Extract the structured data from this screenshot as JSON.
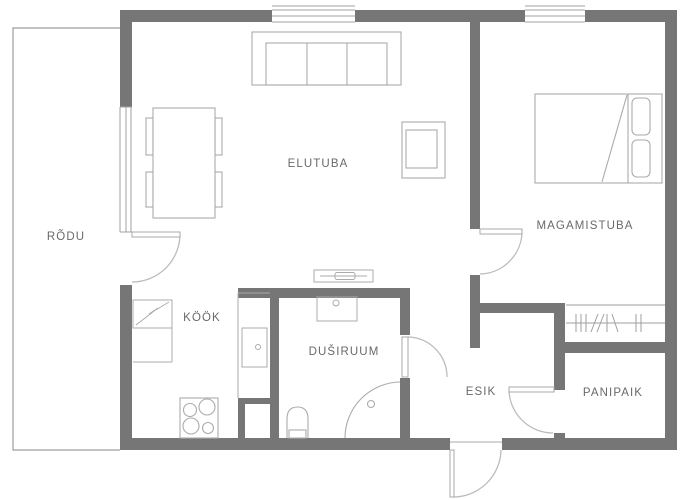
{
  "title": "Apartment floor plan",
  "rooms": [
    {
      "id": "rodu",
      "label": "RÕDU"
    },
    {
      "id": "elutuba",
      "label": "ELUTUBA"
    },
    {
      "id": "magamistuba",
      "label": "MAGAMISTUBA"
    },
    {
      "id": "kook",
      "label": "KÖÖK"
    },
    {
      "id": "dusiruum",
      "label": "DUŠIRUUM"
    },
    {
      "id": "esik",
      "label": "ESIK"
    },
    {
      "id": "panipaik",
      "label": "PANIPAIK"
    }
  ],
  "fixtures": [
    "sofa",
    "dining-table",
    "dining-chairs",
    "armchair",
    "radiator",
    "double-bed",
    "pillows",
    "clothes-rail",
    "electric-boiler",
    "tall-cabinet",
    "kitchen-counter",
    "built-in-appliance",
    "stove",
    "duct-shaft",
    "washbasin",
    "toilet",
    "corner-shower",
    "balcony-door",
    "bedroom-door",
    "shower-room-door",
    "storage-door",
    "entrance-door",
    "window-living-room-top",
    "window-bedroom-top",
    "window-balcony-side"
  ],
  "colors": {
    "wall": "#767676",
    "furniture_line": "#ababab",
    "thin_outline": "#9d9d9d",
    "label_text": "#696969",
    "background": "#ffffff"
  }
}
